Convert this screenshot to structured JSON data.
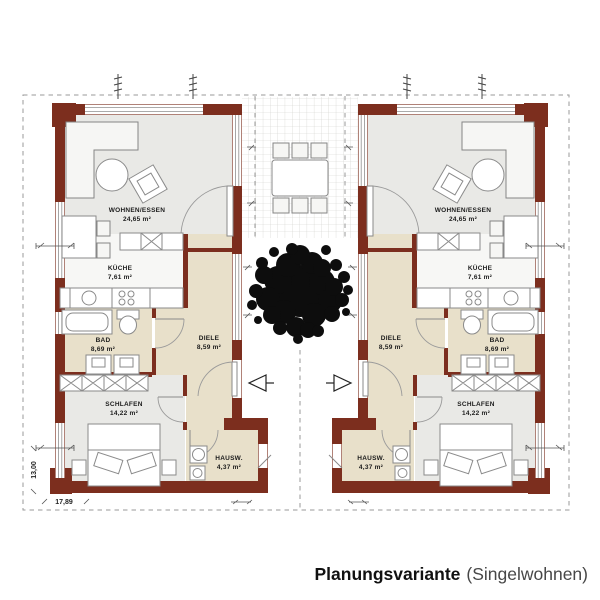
{
  "title": {
    "bold": "Planungsvariante",
    "regular": "(Singelwohnen)"
  },
  "rooms": [
    {
      "name": "WOHNEN/ESSEN",
      "area": "24,65 m²"
    },
    {
      "name": "KÜCHE",
      "area": "7,61 m²"
    },
    {
      "name": "BAD",
      "area": "8,69 m²"
    },
    {
      "name": "DIELE",
      "area": "8,59 m²"
    },
    {
      "name": "SCHLAFEN",
      "area": "14,22 m²"
    },
    {
      "name": "HAUSW.",
      "area": "4,37 m²"
    }
  ],
  "dimensions": {
    "total_width": "17,89",
    "total_depth": "13,00"
  },
  "colors": {
    "wall": "#7c2e1e",
    "room_gray": "#e9e9e6",
    "room_white": "#f7f7f5",
    "room_beige": "#e8e0ca",
    "tree": "#0d0d0d"
  }
}
